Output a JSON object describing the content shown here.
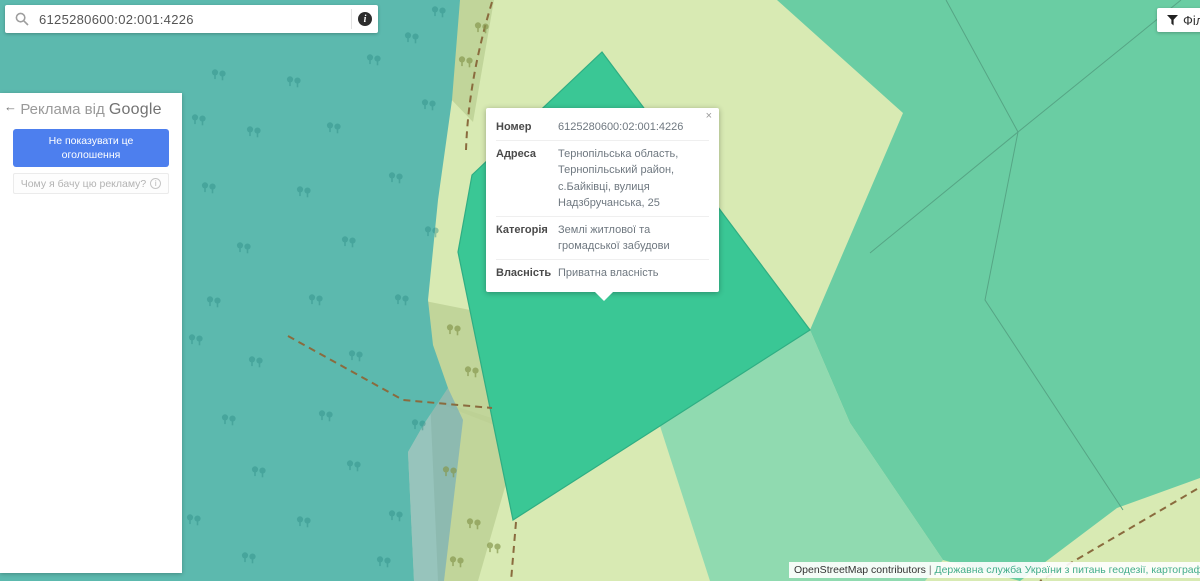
{
  "search": {
    "value": "6125280600:02:001:4226",
    "info_glyph": "i"
  },
  "filter_button": {
    "label": "Фільтр"
  },
  "ad_panel": {
    "back_arrow": "←",
    "title_prefix": "Реклама від",
    "title_brand": "Google",
    "dismiss_label": "Не показувати це оголошення",
    "why_label": "Чому я бачу цю рекламу?",
    "why_info_glyph": "i"
  },
  "popup": {
    "close_glyph": "×",
    "rows": [
      {
        "label": "Номер",
        "value": "6125280600:02:001:4226"
      },
      {
        "label": "Адреса",
        "value": "Тернопільська область, Тернопільський район, с.Байківці, вулиця Надзбручанська, 25"
      },
      {
        "label": "Категорія",
        "value": "Землі житлової та громадської забудови"
      },
      {
        "label": "Власність",
        "value": "Приватна власність"
      }
    ]
  },
  "attribution": {
    "osm": "OpenStreetMap contributors",
    "separator": "|",
    "gov": "Державна служба України з питань геодезії, картографії та ка"
  },
  "map": {
    "colors": {
      "base_pale": "#d8eab3",
      "forest": "#5cb9ae",
      "olive": "#bcd094",
      "river": "#62a4c3",
      "parcel_selected": "#3ac795",
      "parcel_selected_border": "#2fae83",
      "green_parcels": "#6acda3",
      "seafoam_parcel": "#90dab0",
      "boundary_line": "#56a585",
      "path_dashed": "#8a6b3e",
      "trees_forest": "#2e8f87",
      "trees_olive": "#87994f"
    }
  }
}
